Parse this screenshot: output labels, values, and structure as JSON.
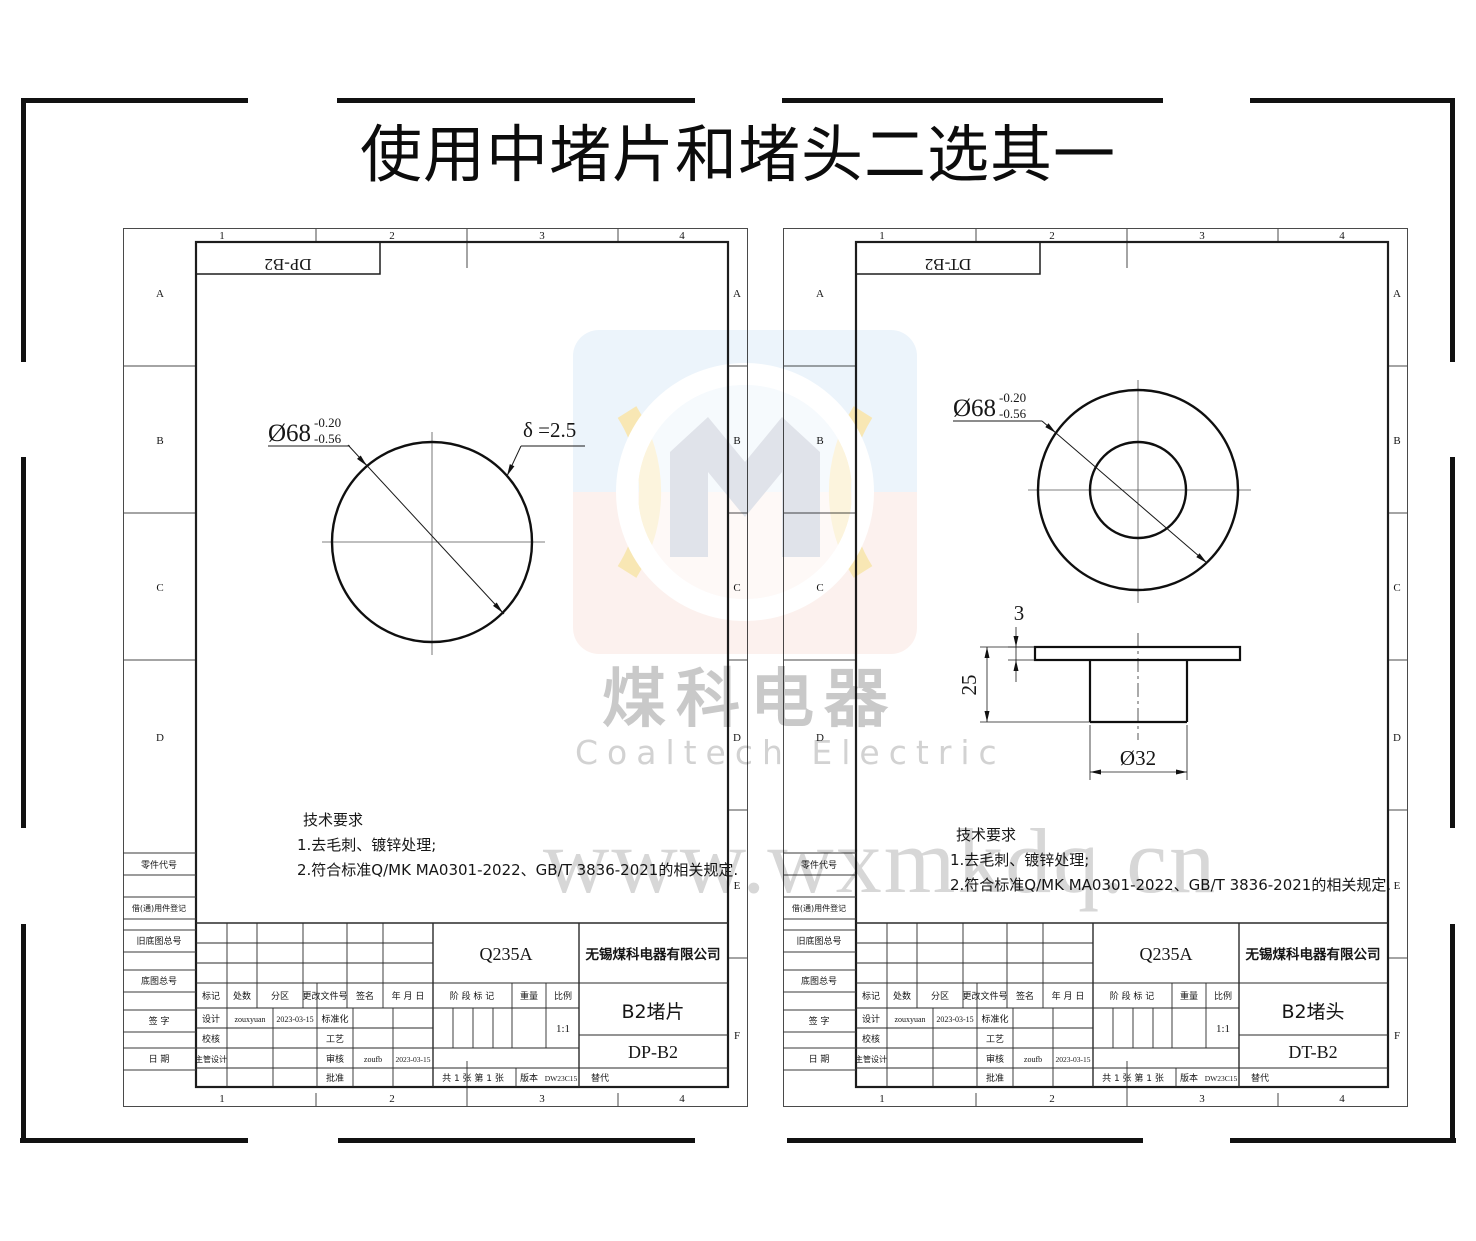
{
  "page_title": "使用中堵片和堵头二选其一",
  "watermark": {
    "cn": "煤科电器",
    "en": "Coaltech Electric",
    "url": "www.wxmkdq.cn"
  },
  "sheets": [
    {
      "code": "DP-B2",
      "cols": [
        "1",
        "2",
        "3",
        "4"
      ],
      "rows_left": [
        "A",
        "B",
        "C",
        "D"
      ],
      "rows_right": [
        "A",
        "B",
        "C",
        "D",
        "E",
        "F"
      ],
      "side_labels": [
        "零件代号",
        "借(通)用件登记",
        "旧底图总号",
        "底图总号",
        "签 字",
        "日 期"
      ],
      "dim_diameter": "Ø68",
      "dim_tol_up": "-0.20",
      "dim_tol_low": "-0.56",
      "dim_delta": "δ =2.5",
      "tech_title": "技术要求",
      "tech_1": "1.去毛刺、镀锌处理;",
      "tech_2": "2.符合标准Q/MK MA0301-2022、GB/T 3836-2021的相关规定.",
      "tb": {
        "material": "Q235A",
        "company": "无锡煤科电器有限公司",
        "part": "B2堵片",
        "dwg": "DP-B2",
        "h_biaoji": "标记",
        "h_chushu": "处数",
        "h_fenqu": "分区",
        "h_wenjian": "更改文件号",
        "h_qianming": "签名",
        "h_riqi": "年 月 日",
        "r1l": "设计",
        "r1sig": "zouxyuan",
        "r1date": "2023-03-15",
        "r1r": "标准化",
        "r2l": "校核",
        "r2r": "工艺",
        "r3l": "主管设计",
        "r3r": "审核",
        "r3sig": "zoufb",
        "r3date": "2023-03-15",
        "r4r": "批准",
        "stage": "阶 段 标 记",
        "weight": "重量",
        "scale": "比例",
        "scale_v": "1:1",
        "sheets_info": "共 1 张  第 1 张",
        "ver": "版本",
        "ver_v": "DW23C15",
        "rep": "替代"
      }
    },
    {
      "code": "DT-B2",
      "cols": [
        "1",
        "2",
        "3",
        "4"
      ],
      "rows_left": [
        "A",
        "B",
        "C",
        "D"
      ],
      "rows_right": [
        "A",
        "B",
        "C",
        "D",
        "E",
        "F"
      ],
      "side_labels": [
        "零件代号",
        "借(通)用件登记",
        "旧底图总号",
        "底图总号",
        "签 字",
        "日 期"
      ],
      "dim_diameter": "Ø68",
      "dim_tol_up": "-0.20",
      "dim_tol_low": "-0.56",
      "dim_3": "3",
      "dim_25": "25",
      "dim_32": "Ø32",
      "tech_title": "技术要求",
      "tech_1": "1.去毛刺、镀锌处理;",
      "tech_2": "2.符合标准Q/MK MA0301-2022、GB/T 3836-2021的相关规定.",
      "tb": {
        "material": "Q235A",
        "company": "无锡煤科电器有限公司",
        "part": "B2堵头",
        "dwg": "DT-B2",
        "h_biaoji": "标记",
        "h_chushu": "处数",
        "h_fenqu": "分区",
        "h_wenjian": "更改文件号",
        "h_qianming": "签名",
        "h_riqi": "年 月 日",
        "r1l": "设计",
        "r1sig": "zouxyuan",
        "r1date": "2023-03-15",
        "r1r": "标准化",
        "r2l": "校核",
        "r2r": "工艺",
        "r3l": "主管设计",
        "r3r": "审核",
        "r3sig": "zoufb",
        "r3date": "2023-03-15",
        "r4r": "批准",
        "stage": "阶 段 标 记",
        "weight": "重量",
        "scale": "比例",
        "scale_v": "1:1",
        "sheets_info": "共 1 张  第 1 张",
        "ver": "版本",
        "ver_v": "DW23C15",
        "rep": "替代"
      }
    }
  ]
}
